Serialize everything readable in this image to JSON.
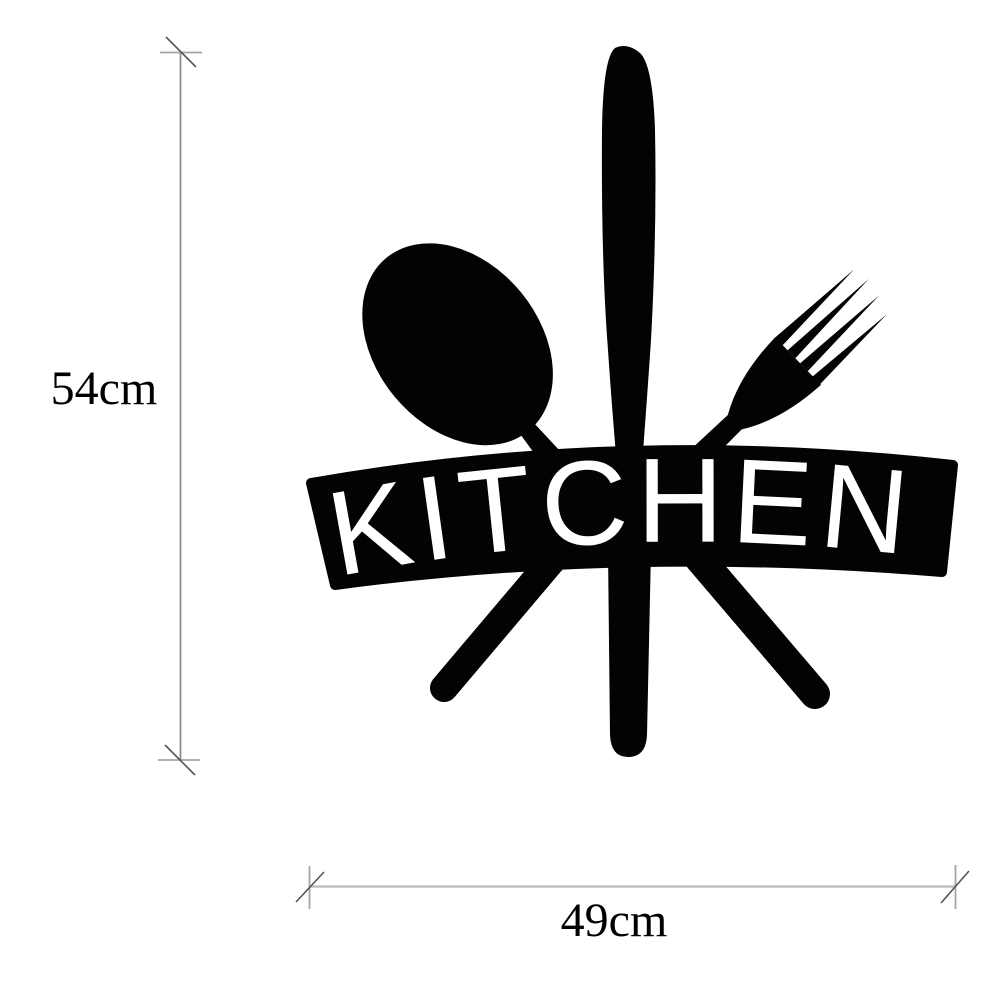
{
  "figure": {
    "type": "product-dimension-diagram",
    "description": "Black metal kitchen wall art silhouette (spoon, knife, fork over arched KITCHEN banner) with height and width dimension lines"
  },
  "banner": {
    "text": "KITCHEN"
  },
  "dimensions": {
    "height_label": "54cm",
    "width_label": "49cm"
  },
  "icons": {
    "spoon": "spoon-icon",
    "knife": "knife-icon",
    "fork": "fork-icon"
  },
  "colors": {
    "artwork": "#030303",
    "banner_letters": "#ffffff",
    "background": "#ffffff",
    "dimension_line_vertical": "#8d8d8d",
    "dimension_line_horizontal": "#c0c0c0",
    "tick_slash": "#555555",
    "label_text": "#000000"
  }
}
